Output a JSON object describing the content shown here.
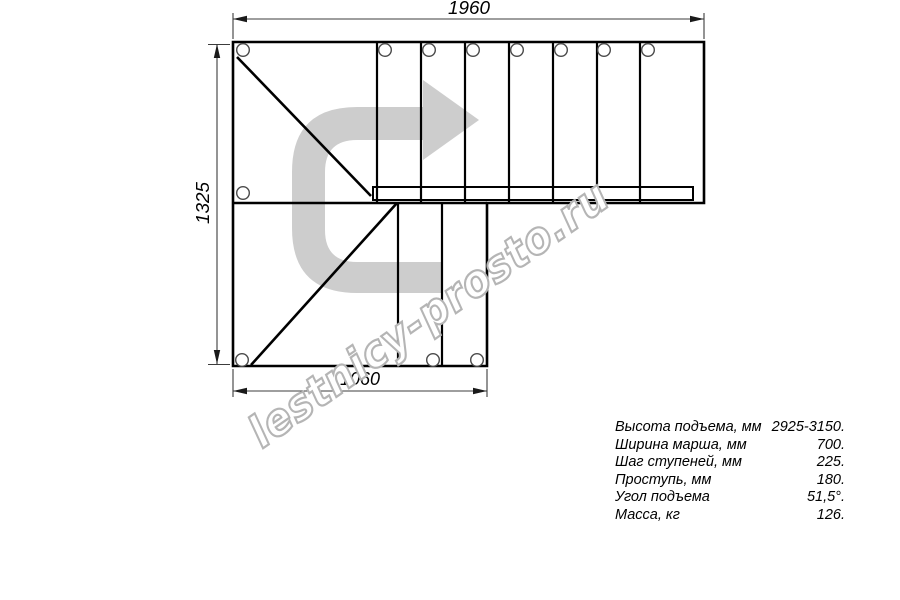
{
  "drawing": {
    "dimensions": {
      "top": "1960",
      "left": "1325",
      "bottom": "1060"
    },
    "watermark": "lestnicy-prosto.ru"
  },
  "specs": {
    "rows": [
      {
        "label": "Высота подъема, мм",
        "value": "2925-3150."
      },
      {
        "label": "Ширина марша, мм",
        "value": "700."
      },
      {
        "label": "Шаг ступеней, мм",
        "value": "225."
      },
      {
        "label": "Проступь, мм",
        "value": "180."
      },
      {
        "label": "Угол подъема",
        "value": "51,5°."
      },
      {
        "label": "Масса, кг",
        "value": "126."
      }
    ]
  },
  "colors": {
    "line": "#000000",
    "dimension_line": "#3c3c3c",
    "arrow_gray": "#cdcdcd",
    "watermark_gray": "#b5b5b5",
    "background": "#ffffff"
  }
}
